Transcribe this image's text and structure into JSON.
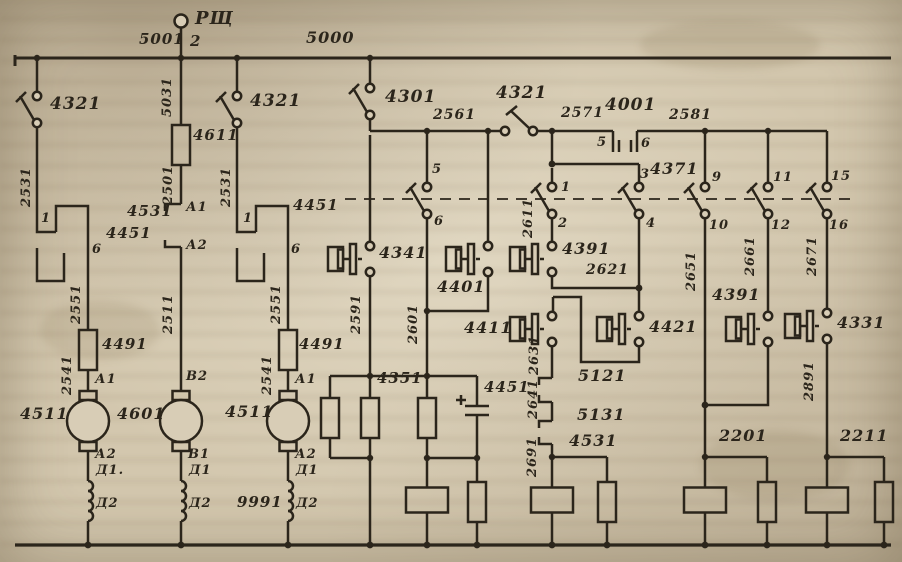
{
  "diagram": {
    "colors": {
      "paper": "#d3c7ae",
      "ink": "#2b251b"
    },
    "labels": [
      {
        "id": "rsch-terminal",
        "text": "РЩ",
        "x": 195,
        "y": 10,
        "size": 18
      },
      {
        "id": "wire-5001",
        "text": "5001",
        "x": 139,
        "y": 32,
        "size": 15
      },
      {
        "id": "terminal-2",
        "text": "2",
        "x": 190,
        "y": 34,
        "size": 15
      },
      {
        "id": "bus-5000",
        "text": "5000",
        "x": 306,
        "y": 30,
        "size": 16
      },
      {
        "id": "switch-4321-a",
        "text": "4321",
        "x": 50,
        "y": 96,
        "size": 17
      },
      {
        "id": "switch-4321-b",
        "text": "4321",
        "x": 250,
        "y": 93,
        "size": 17
      },
      {
        "id": "switch-4301",
        "text": "4301",
        "x": 385,
        "y": 89,
        "size": 17
      },
      {
        "id": "switch-4321-c",
        "text": "4321",
        "x": 496,
        "y": 85,
        "size": 17
      },
      {
        "id": "wire-2561",
        "text": "2561",
        "x": 433,
        "y": 108,
        "size": 14
      },
      {
        "id": "wire-2571",
        "text": "2571",
        "x": 561,
        "y": 106,
        "size": 14
      },
      {
        "id": "contact-4001",
        "text": "4001",
        "x": 605,
        "y": 97,
        "size": 17
      },
      {
        "id": "wire-2581",
        "text": "2581",
        "x": 669,
        "y": 108,
        "size": 14
      },
      {
        "id": "terminal-5",
        "text": "5",
        "x": 597,
        "y": 136,
        "size": 13
      },
      {
        "id": "terminal-6",
        "text": "6",
        "x": 641,
        "y": 137,
        "size": 13
      },
      {
        "id": "terminal-3",
        "text": "3",
        "x": 640,
        "y": 168,
        "size": 13
      },
      {
        "id": "contact-4371",
        "text": "4371",
        "x": 650,
        "y": 161,
        "size": 16
      },
      {
        "id": "terminal-1",
        "text": "1",
        "x": 561,
        "y": 181,
        "size": 13
      },
      {
        "id": "terminal-2b",
        "text": "2",
        "x": 558,
        "y": 217,
        "size": 13
      },
      {
        "id": "terminal-4",
        "text": "4",
        "x": 646,
        "y": 217,
        "size": 13
      },
      {
        "id": "terminal-9",
        "text": "9",
        "x": 712,
        "y": 171,
        "size": 13
      },
      {
        "id": "terminal-10",
        "text": "10",
        "x": 709,
        "y": 219,
        "size": 13
      },
      {
        "id": "terminal-11",
        "text": "11",
        "x": 773,
        "y": 171,
        "size": 13
      },
      {
        "id": "terminal-12",
        "text": "12",
        "x": 771,
        "y": 219,
        "size": 13
      },
      {
        "id": "terminal-15",
        "text": "15",
        "x": 831,
        "y": 170,
        "size": 13
      },
      {
        "id": "terminal-16",
        "text": "16",
        "x": 829,
        "y": 219,
        "size": 13
      },
      {
        "id": "terminal-5s",
        "text": "5",
        "x": 432,
        "y": 163,
        "size": 13
      },
      {
        "id": "terminal-6s",
        "text": "6",
        "x": 434,
        "y": 215,
        "size": 13
      },
      {
        "id": "resistor-4611",
        "text": "4611",
        "x": 193,
        "y": 128,
        "size": 15
      },
      {
        "id": "contact-4531-a",
        "text": "4531",
        "x": 127,
        "y": 204,
        "size": 15
      },
      {
        "id": "terminal-A1-a",
        "text": "А1",
        "x": 186,
        "y": 201,
        "size": 13
      },
      {
        "id": "terminal-A2-a",
        "text": "А2",
        "x": 186,
        "y": 239,
        "size": 13
      },
      {
        "id": "terminal-1a",
        "text": "1",
        "x": 41,
        "y": 212,
        "size": 13
      },
      {
        "id": "contact-4451-a",
        "text": "4451",
        "x": 106,
        "y": 226,
        "size": 15
      },
      {
        "id": "terminal-6a",
        "text": "6",
        "x": 92,
        "y": 243,
        "size": 13
      },
      {
        "id": "terminal-1b",
        "text": "1",
        "x": 243,
        "y": 212,
        "size": 13
      },
      {
        "id": "contact-4451-b",
        "text": "4451",
        "x": 293,
        "y": 198,
        "size": 15
      },
      {
        "id": "terminal-6b",
        "text": "6",
        "x": 291,
        "y": 243,
        "size": 13
      },
      {
        "id": "resistor-4491-a",
        "text": "4491",
        "x": 102,
        "y": 337,
        "size": 15
      },
      {
        "id": "resistor-4491-b",
        "text": "4491",
        "x": 299,
        "y": 337,
        "size": 15
      },
      {
        "id": "terminal-A1-b",
        "text": "А1",
        "x": 95,
        "y": 373,
        "size": 13
      },
      {
        "id": "terminal-A1-c",
        "text": "А1",
        "x": 295,
        "y": 373,
        "size": 13
      },
      {
        "id": "motor-4511-a",
        "text": "4511",
        "x": 20,
        "y": 406,
        "size": 16
      },
      {
        "id": "motor-4601",
        "text": "4601",
        "x": 117,
        "y": 406,
        "size": 16
      },
      {
        "id": "motor-4511-b",
        "text": "4511",
        "x": 225,
        "y": 404,
        "size": 16
      },
      {
        "id": "terminal-A2-b",
        "text": "А2",
        "x": 95,
        "y": 448,
        "size": 13
      },
      {
        "id": "terminal-B1",
        "text": "В1",
        "x": 188,
        "y": 448,
        "size": 13
      },
      {
        "id": "terminal-A2-c",
        "text": "А2",
        "x": 295,
        "y": 448,
        "size": 13
      },
      {
        "id": "terminal-B2",
        "text": "В2",
        "x": 186,
        "y": 370,
        "size": 13
      },
      {
        "id": "terminal-D1-a",
        "text": "Д1.",
        "x": 96,
        "y": 464,
        "size": 13
      },
      {
        "id": "terminal-D1-b",
        "text": "Д1",
        "x": 189,
        "y": 464,
        "size": 13
      },
      {
        "id": "terminal-D1-c",
        "text": "Д1",
        "x": 296,
        "y": 464,
        "size": 13
      },
      {
        "id": "terminal-D2-a",
        "text": "Д2",
        "x": 96,
        "y": 497,
        "size": 13
      },
      {
        "id": "terminal-D2-b",
        "text": "Д2",
        "x": 189,
        "y": 497,
        "size": 13
      },
      {
        "id": "terminal-D2-c",
        "text": "Д2",
        "x": 296,
        "y": 497,
        "size": 13
      },
      {
        "id": "wire-9991",
        "text": "9991",
        "x": 237,
        "y": 495,
        "size": 15
      },
      {
        "id": "contact-4341",
        "text": "4341",
        "x": 379,
        "y": 245,
        "size": 16
      },
      {
        "id": "contact-4401",
        "text": "4401",
        "x": 437,
        "y": 279,
        "size": 16
      },
      {
        "id": "contact-4411",
        "text": "4411",
        "x": 464,
        "y": 320,
        "size": 16
      },
      {
        "id": "contact-4391-a",
        "text": "4391",
        "x": 562,
        "y": 241,
        "size": 16
      },
      {
        "id": "wire-2621",
        "text": "2621",
        "x": 586,
        "y": 263,
        "size": 14
      },
      {
        "id": "contact-4421",
        "text": "4421",
        "x": 649,
        "y": 319,
        "size": 16
      },
      {
        "id": "contact-4391-b",
        "text": "4391",
        "x": 712,
        "y": 287,
        "size": 16
      },
      {
        "id": "contact-4331",
        "text": "4331",
        "x": 837,
        "y": 315,
        "size": 16
      },
      {
        "id": "junction-4351",
        "text": "4351",
        "x": 377,
        "y": 371,
        "size": 15
      },
      {
        "id": "capacitor-4451",
        "text": "4451",
        "x": 484,
        "y": 380,
        "size": 15
      },
      {
        "id": "contact-5121",
        "text": "5121",
        "x": 578,
        "y": 368,
        "size": 16
      },
      {
        "id": "contact-5131",
        "text": "5131",
        "x": 577,
        "y": 407,
        "size": 16
      },
      {
        "id": "relay-4531",
        "text": "4531",
        "x": 569,
        "y": 433,
        "size": 16
      },
      {
        "id": "group-2201",
        "text": "2201",
        "x": 719,
        "y": 428,
        "size": 16
      },
      {
        "id": "group-2211",
        "text": "2211",
        "x": 840,
        "y": 428,
        "size": 16
      },
      {
        "id": "wire-2531-a",
        "text": "2531",
        "x": 20,
        "y": 207,
        "size": 13,
        "rot": true
      },
      {
        "id": "wire-5031",
        "text": "5031",
        "x": 161,
        "y": 117,
        "size": 13,
        "rot": true
      },
      {
        "id": "wire-2531-b",
        "text": "2531",
        "x": 220,
        "y": 207,
        "size": 13,
        "rot": true
      },
      {
        "id": "wire-2501",
        "text": "2501",
        "x": 162,
        "y": 205,
        "size": 13,
        "rot": true
      },
      {
        "id": "wire-2551-a",
        "text": "2551",
        "x": 70,
        "y": 324,
        "size": 13,
        "rot": true
      },
      {
        "id": "wire-2511",
        "text": "2511",
        "x": 162,
        "y": 334,
        "size": 13,
        "rot": true
      },
      {
        "id": "wire-2551-b",
        "text": "2551",
        "x": 270,
        "y": 324,
        "size": 13,
        "rot": true
      },
      {
        "id": "wire-2541-a",
        "text": "2541",
        "x": 61,
        "y": 395,
        "size": 13,
        "rot": true
      },
      {
        "id": "wire-2541-b",
        "text": "2541",
        "x": 261,
        "y": 395,
        "size": 13,
        "rot": true
      },
      {
        "id": "wire-2591",
        "text": "2591",
        "x": 350,
        "y": 334,
        "size": 13,
        "rot": true
      },
      {
        "id": "wire-2601",
        "text": "2601",
        "x": 407,
        "y": 344,
        "size": 13,
        "rot": true
      },
      {
        "id": "wire-2611",
        "text": "2611",
        "x": 522,
        "y": 238,
        "size": 13,
        "rot": true
      },
      {
        "id": "wire-2631",
        "text": "2631",
        "x": 528,
        "y": 375,
        "size": 13,
        "rot": true
      },
      {
        "id": "wire-2641",
        "text": "2641",
        "x": 527,
        "y": 419,
        "size": 13,
        "rot": true
      },
      {
        "id": "wire-2691",
        "text": "2691",
        "x": 526,
        "y": 477,
        "size": 13,
        "rot": true
      },
      {
        "id": "wire-2651",
        "text": "2651",
        "x": 685,
        "y": 291,
        "size": 13,
        "rot": true
      },
      {
        "id": "wire-2661",
        "text": "2661",
        "x": 744,
        "y": 276,
        "size": 13,
        "rot": true
      },
      {
        "id": "wire-2671",
        "text": "2671",
        "x": 806,
        "y": 276,
        "size": 13,
        "rot": true
      },
      {
        "id": "wire-2891",
        "text": "2891",
        "x": 803,
        "y": 401,
        "size": 13,
        "rot": true
      }
    ]
  }
}
